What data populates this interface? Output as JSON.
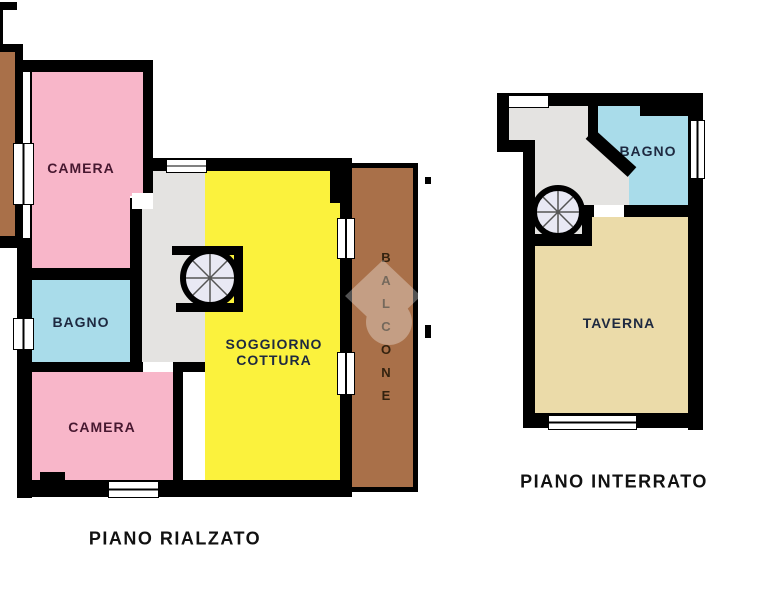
{
  "canvas": {
    "width": 777,
    "height": 600
  },
  "colors": {
    "wall": "#000000",
    "room-pink": "#f8b6c9",
    "room-blue": "#a9dcea",
    "room-yellow": "#fbf23d",
    "room-gray": "#e4e3e1",
    "room-tan": "#ebdba9",
    "balcony-brown": "#a97049",
    "stair-fill": "#e9e9f4",
    "label-maroon": "#471830",
    "label-navy": "#1e2940",
    "label-brown": "#33220f",
    "title-black": "#111111",
    "watermark-white": "#ffffff"
  },
  "plans": {
    "rialzato": {
      "title": "PIANO RIALZATO",
      "rooms": {
        "camera_top": "CAMERA",
        "bagno": "BAGNO",
        "camera_bottom": "CAMERA",
        "soggiorno": "SOGGIORNO\nCOTTURA",
        "balcone": [
          "B",
          "A",
          "L",
          "C",
          "O",
          "N",
          "E"
        ]
      }
    },
    "interrato": {
      "title": "PIANO INTERRATO",
      "rooms": {
        "bagno": "BAGNO",
        "taverna": "TAVERNA"
      }
    }
  }
}
